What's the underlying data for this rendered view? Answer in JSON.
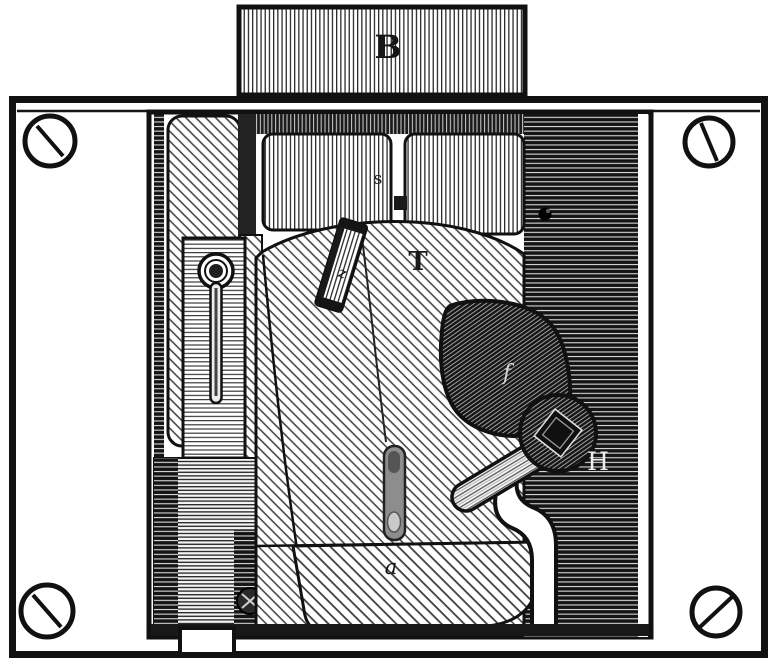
{
  "figure": {
    "ink_color": "#1a1a1a",
    "paper_color": "#ffffff",
    "labels": {
      "b": "B",
      "s": "s",
      "t": "T",
      "z": "z",
      "f": "f",
      "h": "H",
      "a": "a"
    }
  }
}
